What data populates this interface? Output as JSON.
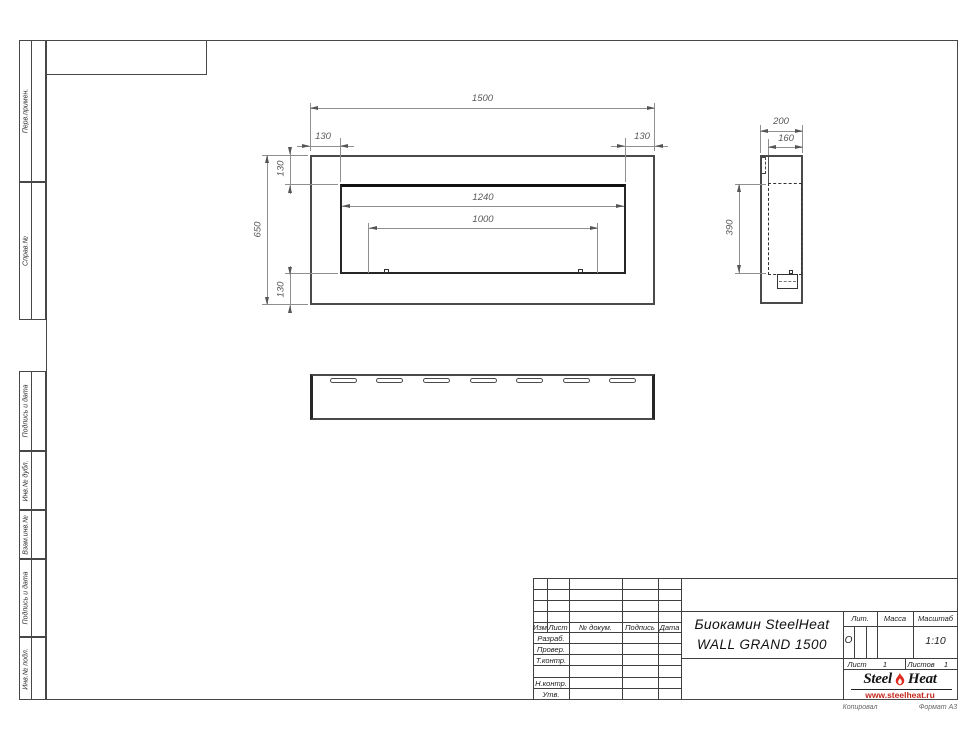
{
  "margin_columns": {
    "items": [
      {
        "label": "Перв.примен."
      },
      {
        "label": "Справ.№"
      },
      {
        "label": "Подпись и дата"
      },
      {
        "label": "Инв.№ дубл."
      },
      {
        "label": "Взам.инв.№"
      },
      {
        "label": "Подпись и дата"
      },
      {
        "label": "Инв.№ подл."
      }
    ]
  },
  "drawing": {
    "front_view": {
      "overall_width": "1500",
      "overall_height": "650",
      "inset_left": "130",
      "inset_right": "130",
      "inset_top": "130",
      "inset_bottom": "130",
      "opening_width": "1240",
      "burner_spacing": "1000"
    },
    "side_view": {
      "depth": "200",
      "inner_depth": "160",
      "opening_height": "390"
    },
    "bottom_view": {
      "slot_count": 7
    }
  },
  "title_block": {
    "columns": {
      "izm": "Изм.",
      "list": "Лист",
      "doc": "№ докум.",
      "sign": "Подпись",
      "date": "Дата"
    },
    "rows": {
      "razrab": "Разраб.",
      "prover": "Провер.",
      "tkontr": "Т.контр.",
      "nkontr": "Н.контр.",
      "utv": "Утв."
    },
    "title_line1": "Биокамин SteelHeat",
    "title_line2": "WALL GRAND 1500",
    "lit_label": "Лит.",
    "lit_value": "О",
    "mass_label": "Масса",
    "scale_label": "Масштаб",
    "scale_value": "1:10",
    "sheet_label": "Лист",
    "sheet_value": "1",
    "sheets_label": "Листов",
    "sheets_value": "1",
    "logo": {
      "steel": "Steel",
      "heat": "Heat",
      "url": "www.steelheat.ru"
    },
    "footer": {
      "copied": "Копировал",
      "format": "Формат А3"
    }
  }
}
